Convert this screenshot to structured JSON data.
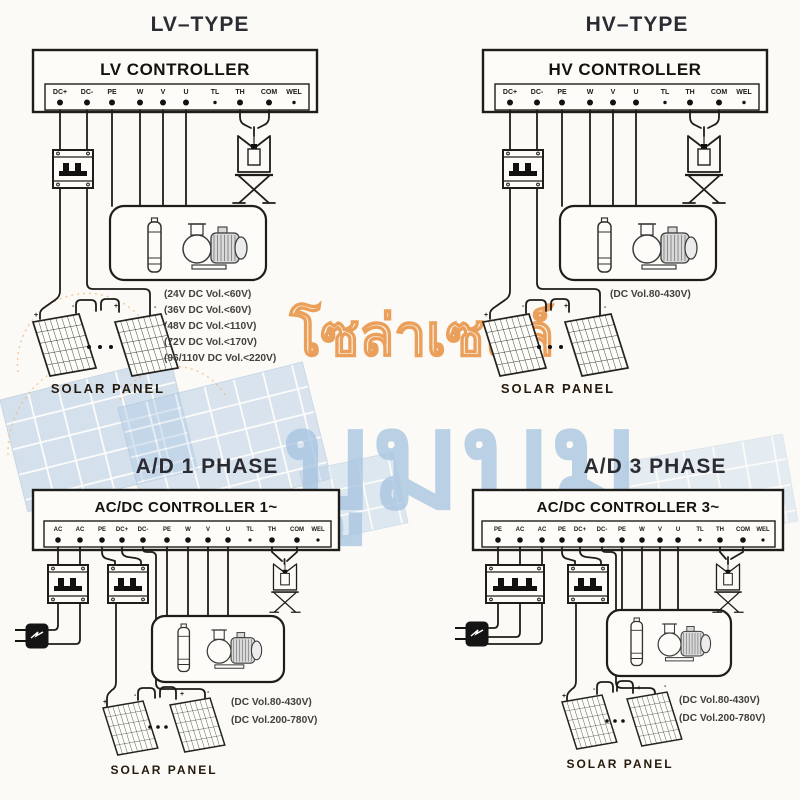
{
  "watermark": {
    "brand_top": "โซล่าเซลล์",
    "brand_main": "บูมบูม",
    "orange": "#e8913f",
    "blue": "#a9c6e2"
  },
  "marks": {
    "plus": "+",
    "minus": "-"
  },
  "quadrants": [
    {
      "title": "LV–TYPE",
      "controller": "LV CONTROLLER",
      "terminals": [
        "DC+",
        "DC-",
        "PE",
        "W",
        "V",
        "U",
        "TL",
        "TH",
        "COM",
        "WEL"
      ],
      "specs": [
        "(24V DC Vol.<60V)",
        "(36V DC Vol.<60V)",
        "(48V DC Vol.<110V)",
        "(72V DC Vol.<170V)",
        "(96/110V DC Vol.<220V)"
      ],
      "panel_label": "SOLAR  PANEL"
    },
    {
      "title": "HV–TYPE",
      "controller": "HV CONTROLLER",
      "terminals": [
        "DC+",
        "DC-",
        "PE",
        "W",
        "V",
        "U",
        "TL",
        "TH",
        "COM",
        "WEL"
      ],
      "specs": [
        "(DC Vol.80-430V)"
      ],
      "panel_label": "SOLAR  PANEL"
    },
    {
      "title": "A/D 1 PHASE",
      "controller": "AC/DC CONTROLLER 1~",
      "terminals": [
        "AC",
        "AC",
        "PE",
        "DC+",
        "DC-",
        "PE",
        "W",
        "V",
        "U",
        "TL",
        "TH",
        "COM",
        "WEL"
      ],
      "specs": [
        "(DC Vol.80-430V)",
        "(DC Vol.200-780V)"
      ],
      "panel_label": "SOLAR  PANEL"
    },
    {
      "title": "A/D 3 PHASE",
      "controller": "AC/DC CONTROLLER 3~",
      "terminals": [
        "PE",
        "AC",
        "AC",
        "PE",
        "DC+",
        "DC-",
        "PE",
        "W",
        "V",
        "U",
        "TL",
        "TH",
        "COM",
        "WEL"
      ],
      "specs": [
        "(DC Vol.80-430V)",
        "(DC Vol.200-780V)"
      ],
      "panel_label": "SOLAR  PANEL"
    }
  ]
}
